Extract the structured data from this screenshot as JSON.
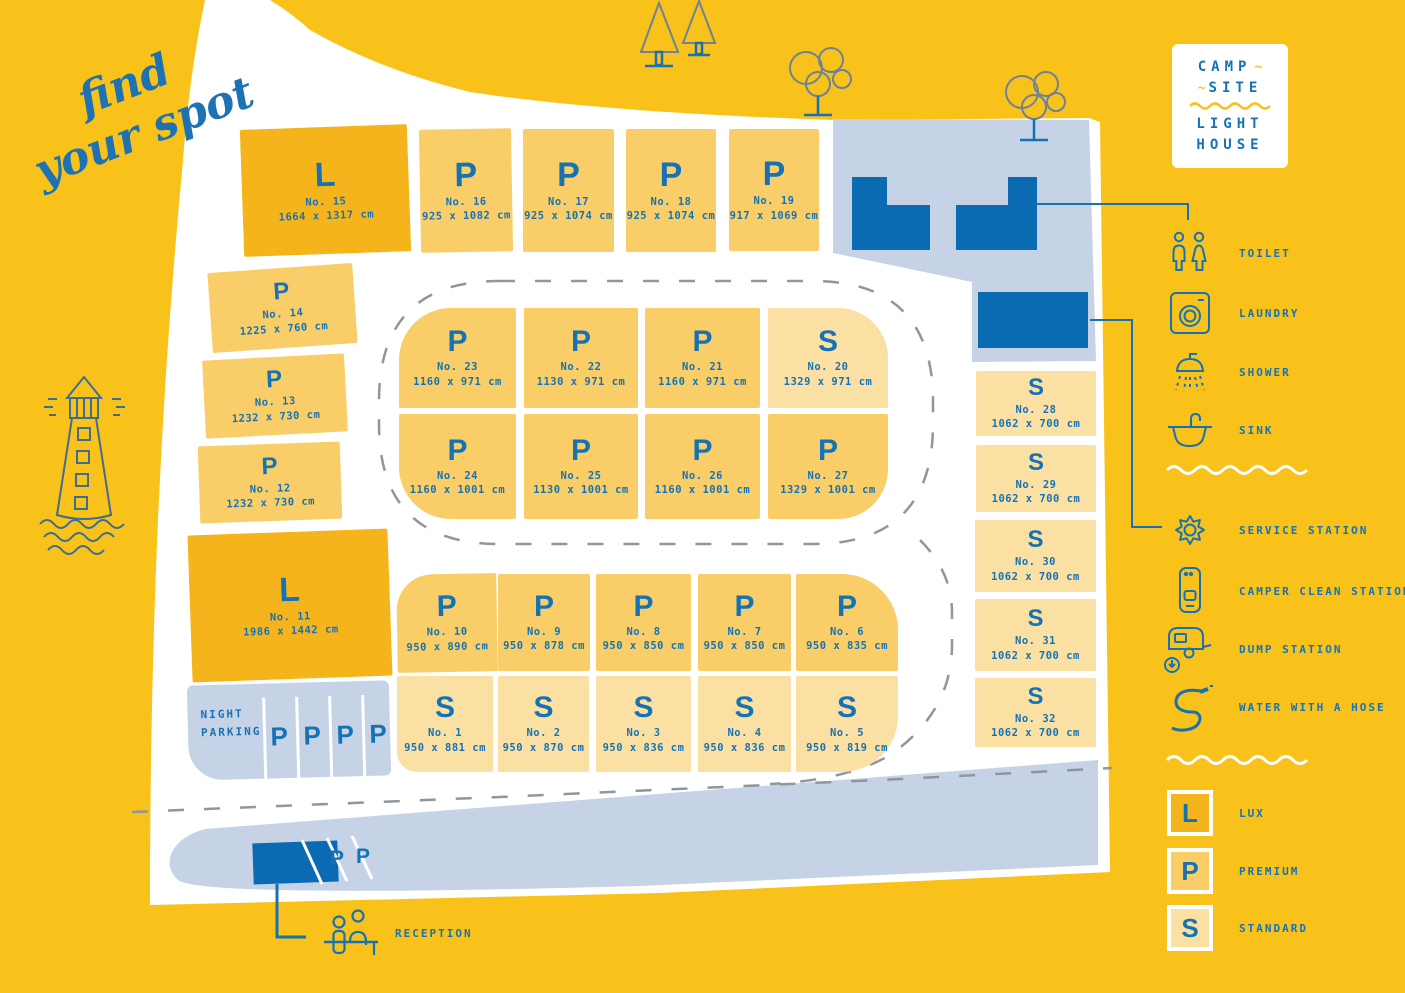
{
  "tagline": {
    "line1": "find",
    "line2": "your spot"
  },
  "logo": {
    "line1": "CAMP",
    "line2": "SITE",
    "line3": "LIGHT",
    "line4": "HOUSE"
  },
  "colors": {
    "background": "#F9C21B",
    "lux": "#F6B41C",
    "premium": "#F9CD67",
    "standard": "#FBE0A4",
    "accent_blue": "#1573B5",
    "building_blue": "#0B6BB2",
    "paved_area": "#C6D3E7",
    "road_white": "#FFFFFF",
    "dash_gray": "#8E969E"
  },
  "plots": [
    {
      "id": 1,
      "type": "S",
      "no": "No. 1",
      "size": "950 x 881 cm"
    },
    {
      "id": 2,
      "type": "S",
      "no": "No. 2",
      "size": "950 x 870 cm"
    },
    {
      "id": 3,
      "type": "S",
      "no": "No. 3",
      "size": "950 x 836 cm"
    },
    {
      "id": 4,
      "type": "S",
      "no": "No. 4",
      "size": "950 x 836 cm"
    },
    {
      "id": 5,
      "type": "S",
      "no": "No. 5",
      "size": "950 x 819 cm"
    },
    {
      "id": 6,
      "type": "P",
      "no": "No. 6",
      "size": "950 x 835 cm"
    },
    {
      "id": 7,
      "type": "P",
      "no": "No. 7",
      "size": "950 x 850 cm"
    },
    {
      "id": 8,
      "type": "P",
      "no": "No. 8",
      "size": "950 x 850 cm"
    },
    {
      "id": 9,
      "type": "P",
      "no": "No. 9",
      "size": "950 x 878 cm"
    },
    {
      "id": 10,
      "type": "P",
      "no": "No. 10",
      "size": "950 x 890 cm"
    },
    {
      "id": 11,
      "type": "L",
      "no": "No. 11",
      "size": "1986 x 1442 cm"
    },
    {
      "id": 12,
      "type": "P",
      "no": "No. 12",
      "size": "1232 x 730 cm"
    },
    {
      "id": 13,
      "type": "P",
      "no": "No. 13",
      "size": "1232 x 730 cm"
    },
    {
      "id": 14,
      "type": "P",
      "no": "No. 14",
      "size": "1225 x 760 cm"
    },
    {
      "id": 15,
      "type": "L",
      "no": "No. 15",
      "size": "1664 x 1317 cm"
    },
    {
      "id": 16,
      "type": "P",
      "no": "No. 16",
      "size": "925 x 1082 cm"
    },
    {
      "id": 17,
      "type": "P",
      "no": "No. 17",
      "size": "925 x 1074 cm"
    },
    {
      "id": 18,
      "type": "P",
      "no": "No. 18",
      "size": "925 x 1074 cm"
    },
    {
      "id": 19,
      "type": "P",
      "no": "No. 19",
      "size": "917 x 1069 cm"
    },
    {
      "id": 20,
      "type": "S",
      "no": "No. 20",
      "size": "1329 x 971 cm"
    },
    {
      "id": 21,
      "type": "P",
      "no": "No. 21",
      "size": "1160 x 971 cm"
    },
    {
      "id": 22,
      "type": "P",
      "no": "No. 22",
      "size": "1130 x 971 cm"
    },
    {
      "id": 23,
      "type": "P",
      "no": "No. 23",
      "size": "1160 x 971 cm"
    },
    {
      "id": 24,
      "type": "P",
      "no": "No. 24",
      "size": "1160 x 1001 cm"
    },
    {
      "id": 25,
      "type": "P",
      "no": "No. 25",
      "size": "1130 x 1001 cm"
    },
    {
      "id": 26,
      "type": "P",
      "no": "No. 26",
      "size": "1160 x 1001 cm"
    },
    {
      "id": 27,
      "type": "P",
      "no": "No. 27",
      "size": "1329 x 1001 cm"
    },
    {
      "id": 28,
      "type": "S",
      "no": "No. 28",
      "size": "1062 x 700 cm"
    },
    {
      "id": 29,
      "type": "S",
      "no": "No. 29",
      "size": "1062 x 700 cm"
    },
    {
      "id": 30,
      "type": "S",
      "no": "No. 30",
      "size": "1062 x 700 cm"
    },
    {
      "id": 31,
      "type": "S",
      "no": "No. 31",
      "size": "1062 x 700 cm"
    },
    {
      "id": 32,
      "type": "S",
      "no": "No. 32",
      "size": "1062 x 700 cm"
    }
  ],
  "night_parking": {
    "label_line1": "NIGHT",
    "label_line2": "PARKING",
    "slot_label": "P",
    "slots": 4
  },
  "reception": {
    "label": "RECEPTION",
    "parking_slot_label": "P"
  },
  "facilities": [
    {
      "icon": "toilet-icon",
      "label": "TOILET"
    },
    {
      "icon": "laundry-icon",
      "label": "LAUNDRY"
    },
    {
      "icon": "shower-icon",
      "label": "SHOWER"
    },
    {
      "icon": "sink-icon",
      "label": "SINK"
    },
    {
      "icon": "service-station-icon",
      "label": "SERVICE STATION"
    },
    {
      "icon": "camper-clean-station-icon",
      "label": "CAMPER CLEAN STATION"
    },
    {
      "icon": "dump-station-icon",
      "label": "DUMP STATION"
    },
    {
      "icon": "water-hose-icon",
      "label": "WATER WITH A HOSE"
    }
  ],
  "plot_types": [
    {
      "code": "L",
      "label": "LUX"
    },
    {
      "code": "P",
      "label": "PREMIUM"
    },
    {
      "code": "S",
      "label": "STANDARD"
    }
  ]
}
